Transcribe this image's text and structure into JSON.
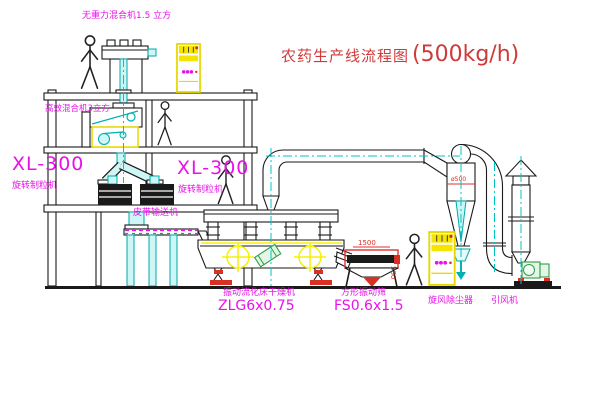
{
  "title": {
    "text": "农药生产线流程图",
    "capacity": "(500kg/h)"
  },
  "equipment_labels": {
    "gravity_mixer": "无重力混合机1.5 立方",
    "high_mixer": "高效混合机3立方",
    "granulator_left_model": "XL-300",
    "granulator_left_name": "旋转制粒机",
    "granulator_right_model": "XL-300",
    "granulator_right_name": "旋转制粒机",
    "belt_conveyor": "皮带输送机",
    "dryer_name": "振动流化床干燥机",
    "dryer_model": "ZLG6x0.75",
    "screen_name": "方形振动筛",
    "screen_model": "FS0.6x1.5",
    "cyclone_name": "旋风除尘器",
    "fan_name": "引风机"
  },
  "dimensions": {
    "screen_length": "1500",
    "screen_height": "580",
    "cyclone_diameter": "ø500"
  },
  "colors": {
    "line": "#1a1a1a",
    "cyan": "#00b0b0",
    "magenta": "#e812e8",
    "red": "#d93025",
    "yellow": "#f5e400",
    "green": "#2f9e44",
    "title_red": "#cf3a3a"
  }
}
